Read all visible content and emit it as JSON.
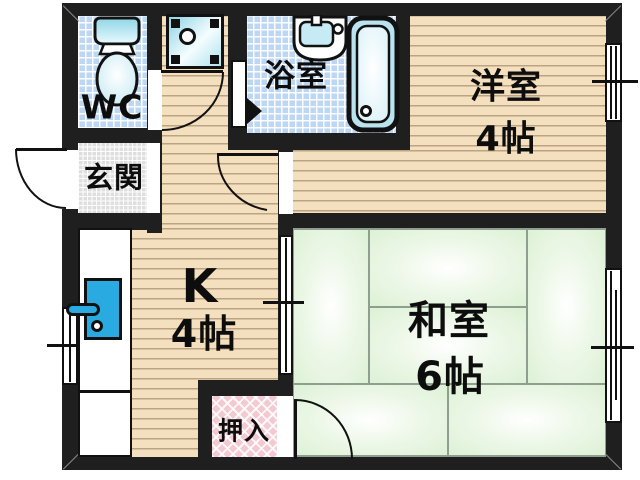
{
  "rooms": {
    "wc": {
      "label": "WC"
    },
    "genkan": {
      "label": "玄関"
    },
    "bathroom": {
      "label": "浴室"
    },
    "western_room": {
      "label": "洋室",
      "size": "4帖"
    },
    "kitchen": {
      "label": "K",
      "size": "4帖"
    },
    "japanese_room": {
      "label": "和室",
      "size": "6帖"
    },
    "closet": {
      "label": "押入"
    }
  },
  "fixtures": {
    "toilet": "toilet-icon",
    "washing_machine_pan": "washing-machine-pan-icon",
    "bathroom_sink": "bath-sink-icon",
    "bathtub": "bathtub-icon",
    "kitchen_counter": "kitchen-counter",
    "kitchen_sink": "kitchen-sink-icon"
  },
  "colors": {
    "wall": "#1f1f1f",
    "wood_floor": "#f4dfbe",
    "tile_blue": "#bdd6f2",
    "tile_grey": "#dedede",
    "tatami_green": "#e4f4de",
    "closet_pink": "#f3c9d2",
    "fixture_cyan": "#29abe2",
    "fixture_cyan_light": "#cdeef7"
  }
}
